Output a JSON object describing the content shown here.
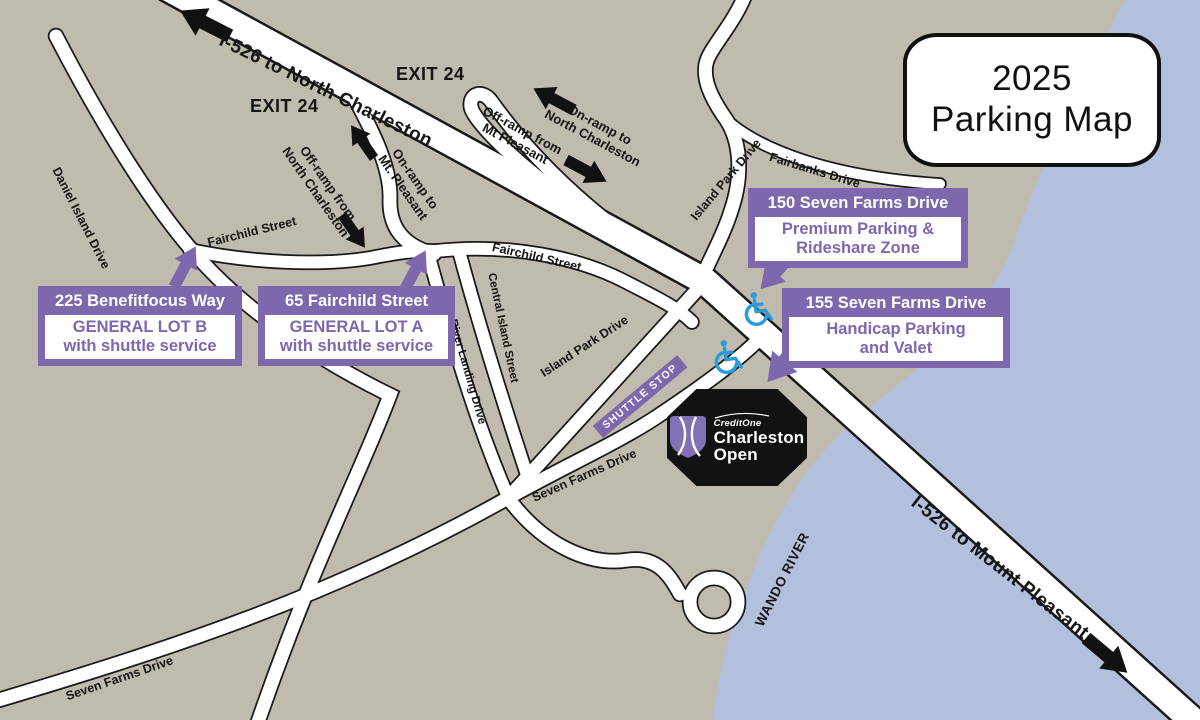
{
  "title": {
    "line1": "2025",
    "line2": "Parking Map"
  },
  "highway": {
    "north_label": "I-526 to North Charleston",
    "south_label": "I-526 to Mount Pleasant"
  },
  "exits": {
    "left": "EXIT 24",
    "right": "EXIT 24"
  },
  "ramps": {
    "on_nc_1": "On-ramp to",
    "on_nc_2": "North Charleston",
    "off_mtp_1": "Off-ramp from",
    "off_mtp_2": "Mt Pleasant",
    "off_nc_1": "Off-ramp from",
    "off_nc_2": "North Charleston",
    "on_mtp_1": "On-ramp to",
    "on_mtp_2": "Mt. Pleasant"
  },
  "streets": {
    "daniel_island": "Daniel Island Drive",
    "fairchild_left": "Fairchild Street",
    "fairchild_right": "Fairchild Street",
    "central_island": "Central Island Street",
    "river_landing": "River Landing Drive",
    "island_park_upper": "Island Park Drive",
    "island_park_lower": "Island Park Drive",
    "fairbanks": "Fairbanks Drive",
    "seven_farms_mid": "Seven Farms Drive",
    "seven_farms_bottom": "Seven Farms Drive",
    "wando_river": "WANDO RIVER"
  },
  "parking": {
    "lot_b": {
      "address": "225 Benefitfocus Way",
      "line1": "GENERAL LOT B",
      "line2": "with shuttle service"
    },
    "lot_a": {
      "address": "65 Fairchild Street",
      "line1": "GENERAL LOT A",
      "line2": "with shuttle service"
    },
    "premium": {
      "address": "150 Seven Farms Drive",
      "line1": "Premium Parking &",
      "line2": "Rideshare Zone"
    },
    "handicap": {
      "address": "155 Seven Farms Drive",
      "line1": "Handicap Parking",
      "line2": "and Valet"
    }
  },
  "shuttle_stop": "SHUTTLE STOP",
  "venue": {
    "brand": "CreditOne",
    "name1": "Charleston",
    "name2": "Open"
  },
  "colors": {
    "purple": "#7d67ad",
    "water": "#b2c0dd",
    "land": "#bfbbae",
    "road_fill": "#ffffff",
    "road_casing": "#1a1a1a",
    "handicap_blue": "#2a9cd8"
  }
}
